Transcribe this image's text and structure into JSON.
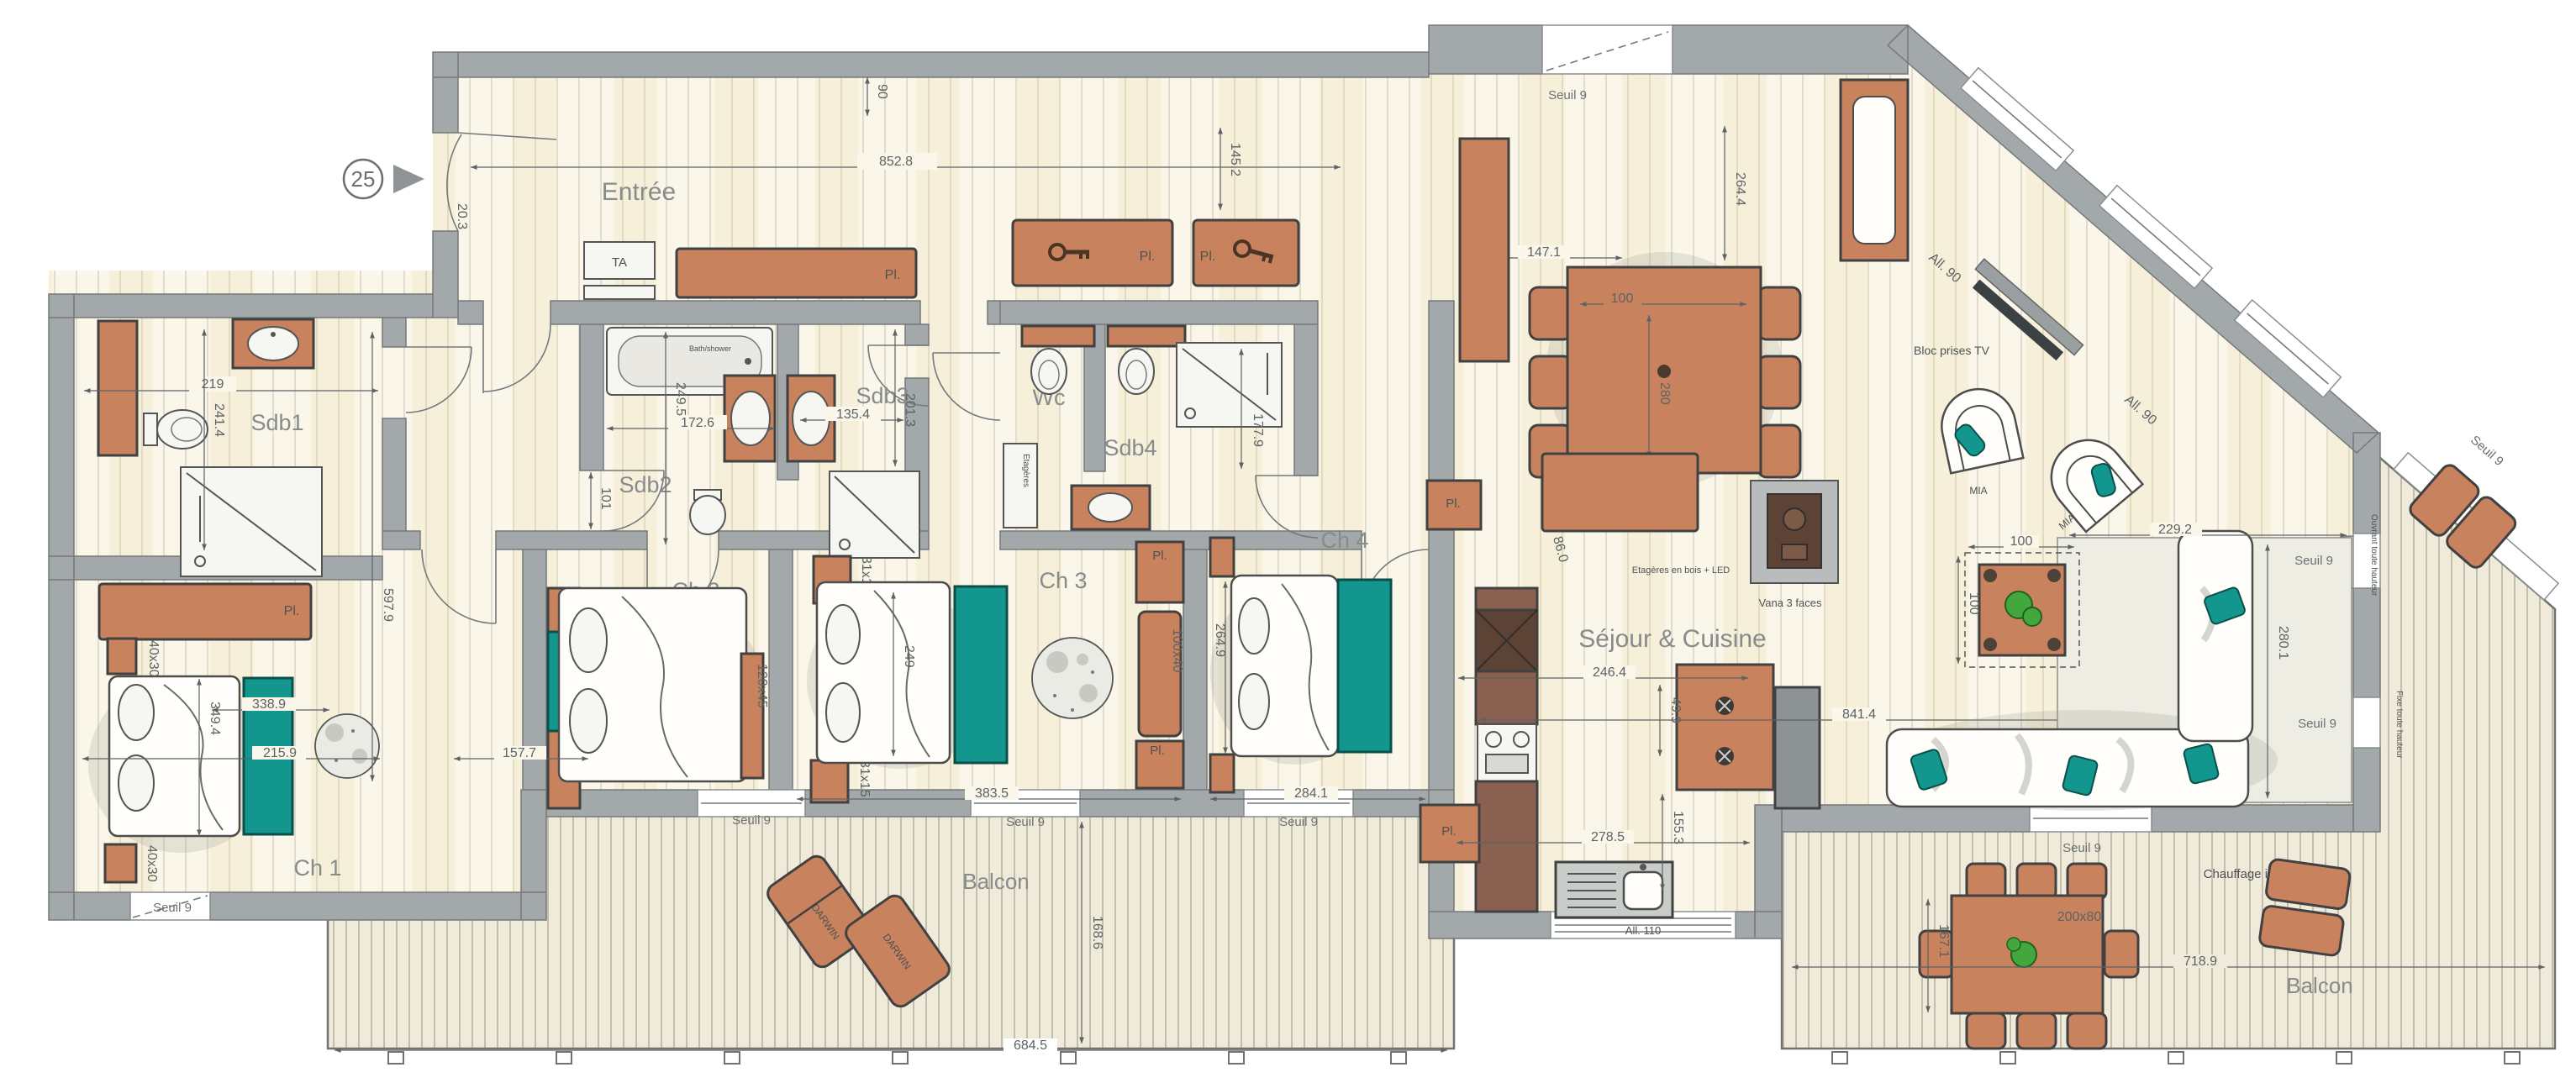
{
  "t": {
    "unit": "25",
    "entree": "Entrée",
    "sdb1": "Sdb1",
    "sdb2": "Sdb2",
    "sdb3": "Sdb3",
    "sdb4": "Sdb4",
    "wc": "Wc",
    "ch1": "Ch 1",
    "ch2": "Ch 2",
    "ch3": "Ch 3",
    "ch4": "Ch 4",
    "sejour": "Séjour & Cuisine",
    "balcon": "Balcon",
    "pl": "Pl.",
    "ta": "TA",
    "seuil": "Seuil 9",
    "mia": "MIA",
    "darwin": "DARWIN",
    "bloc": "Bloc prises TV",
    "vana": "Vana 3 faces",
    "etag_led": "Etagères en bois + LED",
    "etageres": "Etagères",
    "bath": "Bath/shower",
    "chauffage": "Chauffage infrarouge",
    "all90": "All. 90",
    "all110": "All. 110",
    "ouvrant": "Ouvrant toute hauteur",
    "fixe": "Fixe toute hauteur"
  },
  "d": {
    "w852": "852.8",
    "v90": "90",
    "v203": "20.3",
    "s1w": "219",
    "s1h": "241.4",
    "corr": "597.9",
    "s2w": "172.6",
    "s2h": "249.5",
    "s2d": "101",
    "s3w": "135.4",
    "s3h": "201.3",
    "wcw": "145.2",
    "s4h": "177.9",
    "c1a": "338.9",
    "c1b": "349.4",
    "c1c": "215.9",
    "c2a": "157.7",
    "c3a": "249",
    "c3b": "383.5",
    "c4a": "264.9",
    "c4b": "284.1",
    "t100": "100",
    "t280": "280",
    "t147": "147.1",
    "t264": "264.4",
    "k246": "246.4",
    "k49": "49.9",
    "k86": "86.0",
    "k841": "841.4",
    "k278": "278.5",
    "k155": "155.3",
    "r229": "229.2",
    "r280": "280.1",
    "rug": "350x250",
    "b684": "684.5",
    "b168": "168.6",
    "b718": "718.9",
    "b167": "167.1",
    "tout": "200x80",
    "n40": "40x30",
    "n31": "31x15",
    "bench120": "120x45",
    "bench100": "100x40"
  }
}
